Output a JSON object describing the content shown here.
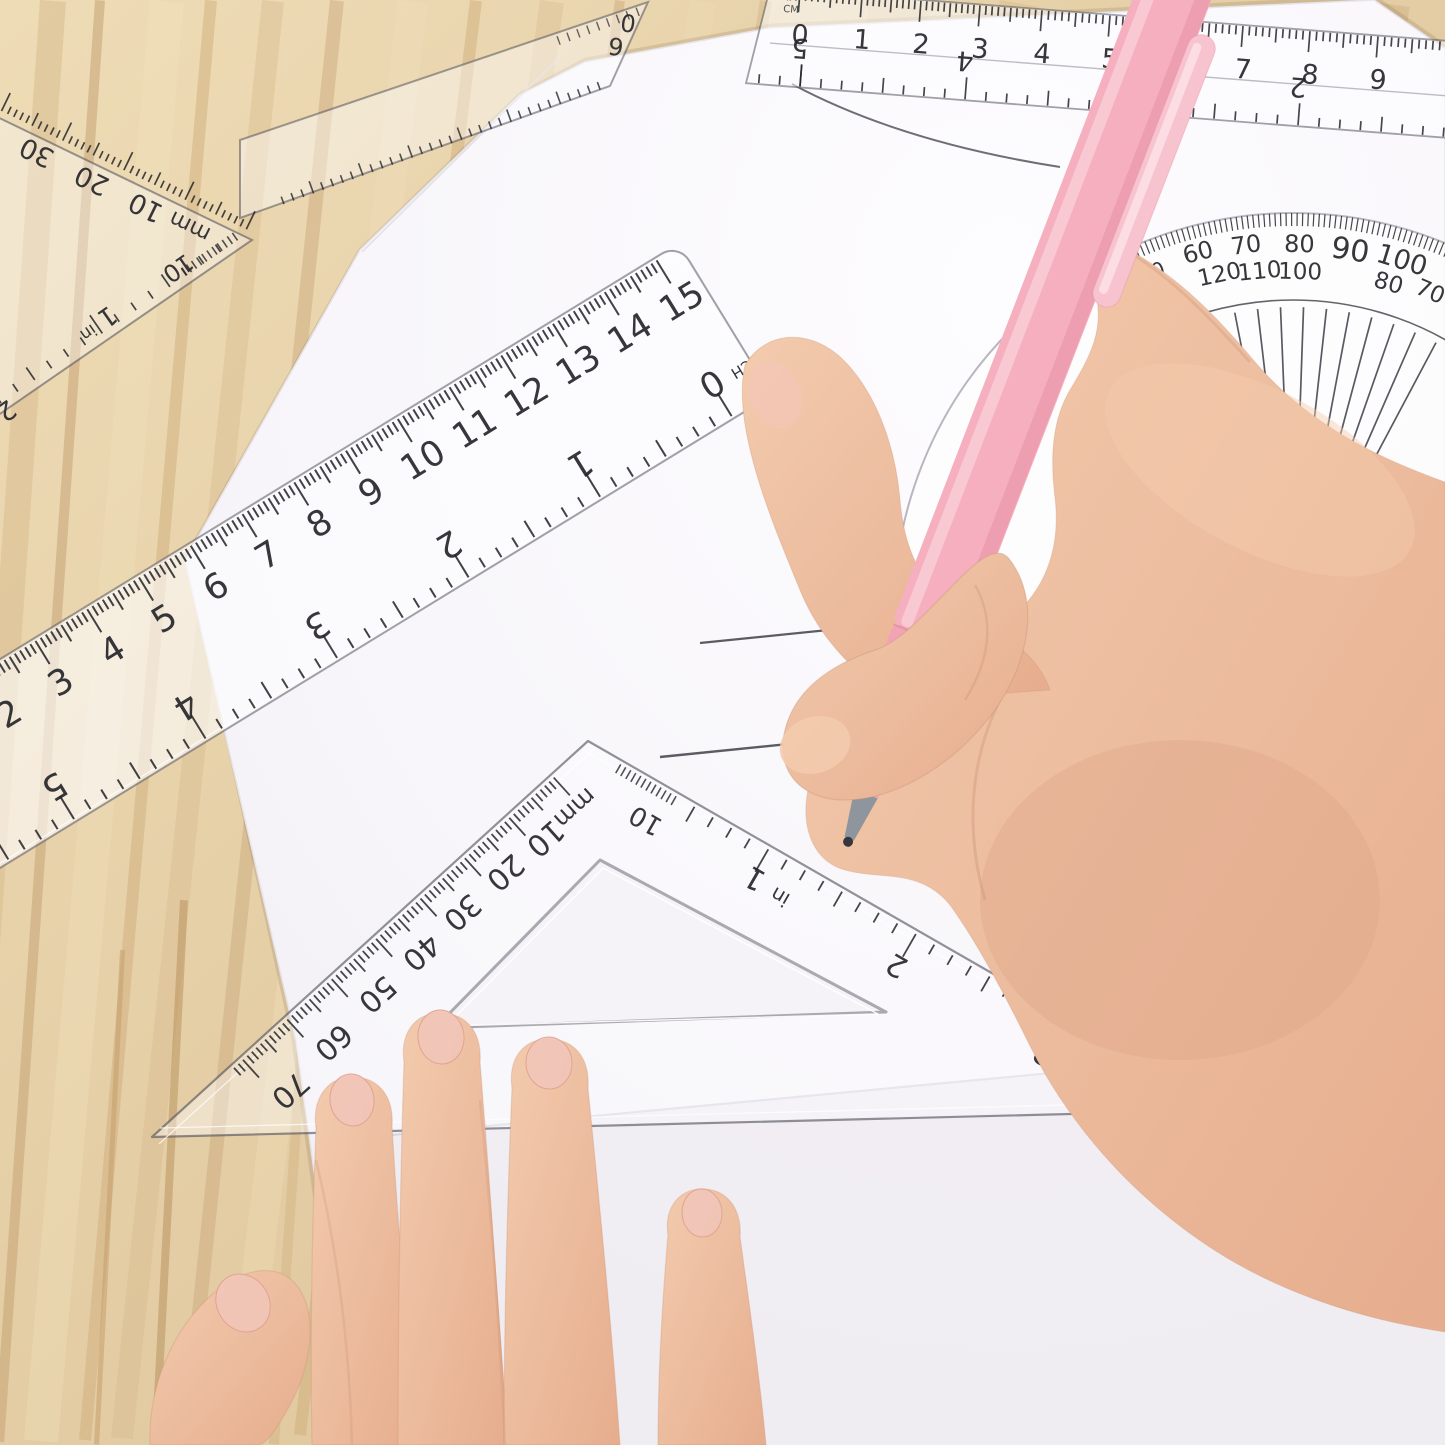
{
  "instruments": {
    "top_ruler": {
      "cm_labels": [
        "0",
        "1",
        "2",
        "3",
        "4",
        "5",
        "6",
        "7",
        "8",
        "9"
      ],
      "inch_labels": [
        "5",
        "4",
        "3",
        "2"
      ],
      "unit_labels": [
        "MM",
        "CM"
      ]
    },
    "under_ruler_end": {
      "marks": [
        "0",
        "6"
      ]
    },
    "top_left_set_square": {
      "mm_labels": [
        "30",
        "20",
        "10",
        "mm"
      ],
      "inch_edge_labels": [
        "10",
        "1",
        "in",
        "2"
      ]
    },
    "mid_ruler": {
      "cm_labels": [
        "0",
        "1",
        "2",
        "3",
        "4",
        "5",
        "6",
        "7",
        "8",
        "9",
        "10",
        "11",
        "12",
        "13",
        "14",
        "15"
      ],
      "inch_labels": [
        "0",
        "1",
        "2",
        "3",
        "4",
        "5"
      ],
      "inch_unit": "INCH"
    },
    "center_set_square": {
      "mm_labels": [
        "mm",
        "10",
        "20",
        "30",
        "40",
        "50",
        "60",
        "70"
      ],
      "inch_edge_labels": [
        "10",
        "1",
        "in",
        "2",
        "3"
      ]
    },
    "protractor": {
      "outer_labels": [
        "0",
        "60",
        "70",
        "80",
        "90",
        "100"
      ],
      "inner_labels": [
        "120",
        "110",
        "100",
        "80",
        "70"
      ]
    }
  },
  "palette": {
    "wood": "#e6d0a8",
    "wood_streak": "#cfae7c",
    "paper": "#f7f5f9",
    "paper_under": "#efecf2",
    "plastic_edge": "#5a5a64",
    "ink": "#26262b",
    "pencil": "#4b4b52",
    "skin_light": "#f3cbae",
    "skin_mid": "#e6ad8e",
    "skin_shadow": "#c98f72",
    "nail": "#f2c6b8",
    "pen_pink": "#f5afbe",
    "pen_shade": "#e591a5",
    "pen_light": "#fbd4dc",
    "pen_clip": "#f7c3ce",
    "pen_metal": "#8f959d",
    "pen_tip": "#34383e"
  }
}
